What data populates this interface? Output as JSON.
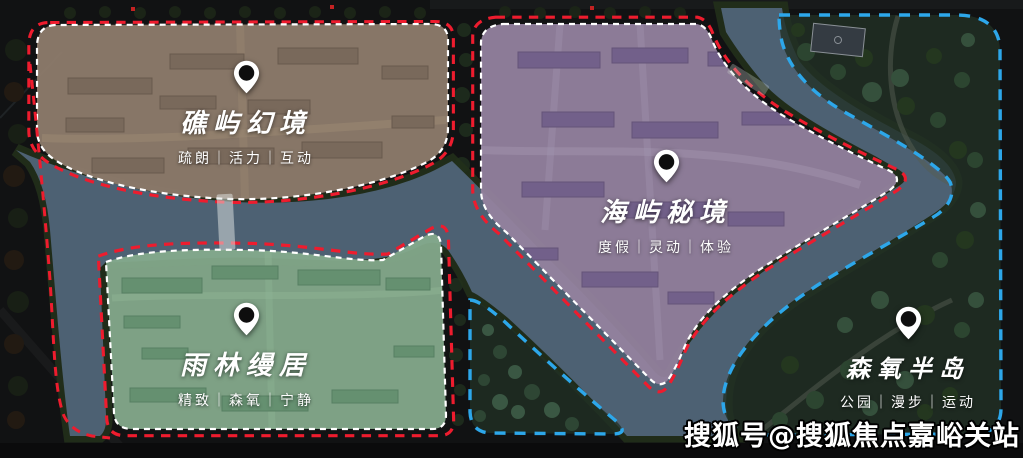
{
  "map": {
    "watermark": "搜狐号@搜狐焦点嘉峪关站",
    "colors": {
      "background": "#111213",
      "river": "#4d6173",
      "river_bank": "#22301b",
      "red_dash": "#ee1c2e",
      "white_dash": "#ffffff",
      "blue_dash": "#2da7ea"
    },
    "zones": [
      {
        "id": "jiaoyu-huanjing",
        "title": "礁屿幻境",
        "tagline": "疏朗｜活力｜互动",
        "fill": "#8d7b6b"
      },
      {
        "id": "haiyu-mijing",
        "title": "海屿秘境",
        "tagline": "度假｜灵动｜体验",
        "fill": "#94829e"
      },
      {
        "id": "yulin-manju",
        "title": "雨林缦居",
        "tagline": "精致｜森氧｜宁静",
        "fill": "#85aa8c"
      },
      {
        "id": "senyang-bandao",
        "title": "森氧半岛",
        "tagline": "公园｜漫步｜运动",
        "fill": "#223126"
      }
    ]
  }
}
